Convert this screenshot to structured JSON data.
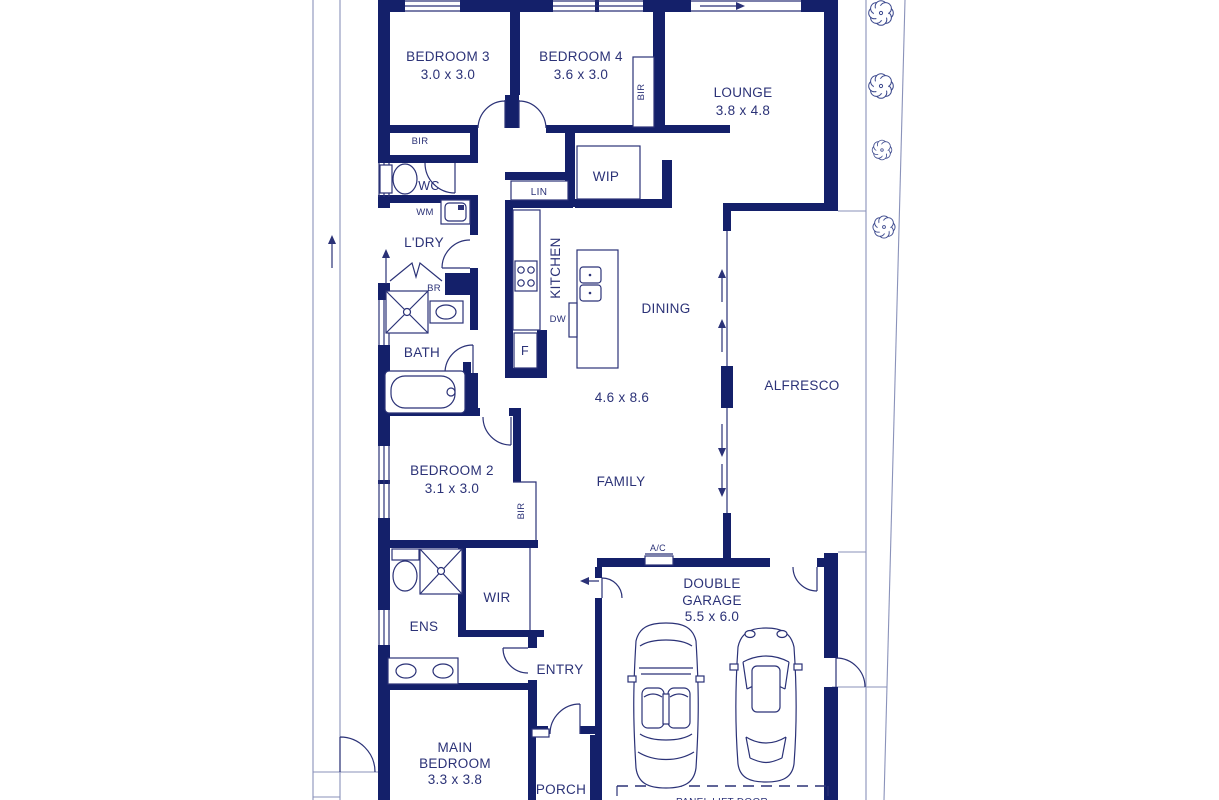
{
  "plan": {
    "rooms": {
      "bedroom3": {
        "name": "BEDROOM 3",
        "dims": "3.0 x 3.0"
      },
      "bedroom4": {
        "name": "BEDROOM 4",
        "dims": "3.6 x 3.0"
      },
      "lounge": {
        "name": "LOUNGE",
        "dims": "3.8 x 4.8"
      },
      "wip": {
        "name": "WIP"
      },
      "kitchen": {
        "name": "KITCHEN"
      },
      "dining": {
        "name": "DINING"
      },
      "family": {
        "name": "FAMILY",
        "dims": "4.6 x 8.6"
      },
      "alfresco": {
        "name": "ALFRESCO"
      },
      "bedroom2": {
        "name": "BEDROOM 2",
        "dims": "3.1 x 3.0"
      },
      "bath": {
        "name": "BATH"
      },
      "ldry": {
        "name": "L'DRY"
      },
      "wc": {
        "name": "WC"
      },
      "ens": {
        "name": "ENS"
      },
      "wir": {
        "name": "WIR"
      },
      "entry": {
        "name": "ENTRY"
      },
      "garage": {
        "line1": "DOUBLE",
        "line2": "GARAGE",
        "dims": "5.5 x 6.0"
      },
      "main_bedroom": {
        "line1": "MAIN",
        "line2": "BEDROOM",
        "dims": "3.3 x 3.8"
      },
      "porch": {
        "name": "PORCH"
      }
    },
    "fixtures": {
      "bir": "BIR",
      "lin": "LIN",
      "wm": "WM",
      "br": "BR",
      "fridge": "F",
      "dw": "DW",
      "ac": "A/C",
      "panel_lift_door": "PANEL LIFT DOOR"
    },
    "colors": {
      "wall": "#14206a",
      "text": "#2b3277",
      "site_lines": "#8a92ba"
    }
  }
}
